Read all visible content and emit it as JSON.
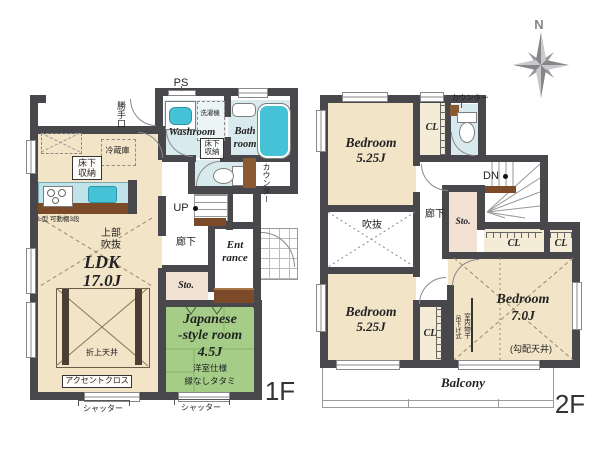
{
  "title": "House floor plan 1F / 2F",
  "colors": {
    "wall": "#47474c",
    "cream": "#f2e4c7",
    "cream2": "#f5ecd8",
    "green": "#a5cd88",
    "blue": "#d8eaed",
    "teal": "#45c2d5",
    "brown": "#7b4a28",
    "brown2": "#8a5a33",
    "pink": "#f1e1d3",
    "line": "#8a8a8a",
    "ink": "#222222",
    "compass": "#86868a"
  },
  "compass": {
    "north": "N"
  },
  "f1": {
    "floor": "1F",
    "ps": "PS",
    "back_door": "勝手口",
    "fridge": "冷蔵庫",
    "underfloor_kitchen": "床下収納",
    "washroom": "Washroom",
    "washer": "洗濯機",
    "underfloor_washroom": "床下収納",
    "bath_1": "Bath",
    "bath_2": "room",
    "counter": "カウンター",
    "up": "UP",
    "hallway": "廊下",
    "entrance_1": "Ent",
    "entrance_2": "rance",
    "sto": "Sto.",
    "ldk_name": "LDK",
    "ldk_size": "17.0J",
    "upper_void_1": "上部",
    "upper_void_2": "吹抜",
    "shelf_note": "L型 可動棚3段",
    "coffered": "折上天井",
    "accent": "アクセントクロス",
    "shutter_left": "シャッター",
    "shutter_right": "シャッター",
    "jp_room_1": "Japanese",
    "jp_room_2": "-style room",
    "jp_room_size": "4.5J",
    "jp_room_note1": "洋室仕様",
    "jp_room_note2": "縁なしタタミ"
  },
  "f2": {
    "floor": "2F",
    "counter": "カウンター",
    "bedroom1_name": "Bedroom",
    "bedroom1_size": "5.25J",
    "cl_top": "CL",
    "dn": "DN",
    "hallway": "廊下",
    "sto": "Sto.",
    "void": "吹抜",
    "cl_mid1": "CL",
    "cl_mid2": "CL",
    "bedroom2_name": "Bedroom",
    "bedroom2_size": "5.25J",
    "cl_bottom": "CL",
    "bedroom3_name": "Bedroom",
    "bedroom3_size": "7.0J",
    "bedroom3_note": "(勾配天井)",
    "drying_1": "室内物干",
    "drying_2": "吊下げ式",
    "balcony": "Balcony"
  }
}
